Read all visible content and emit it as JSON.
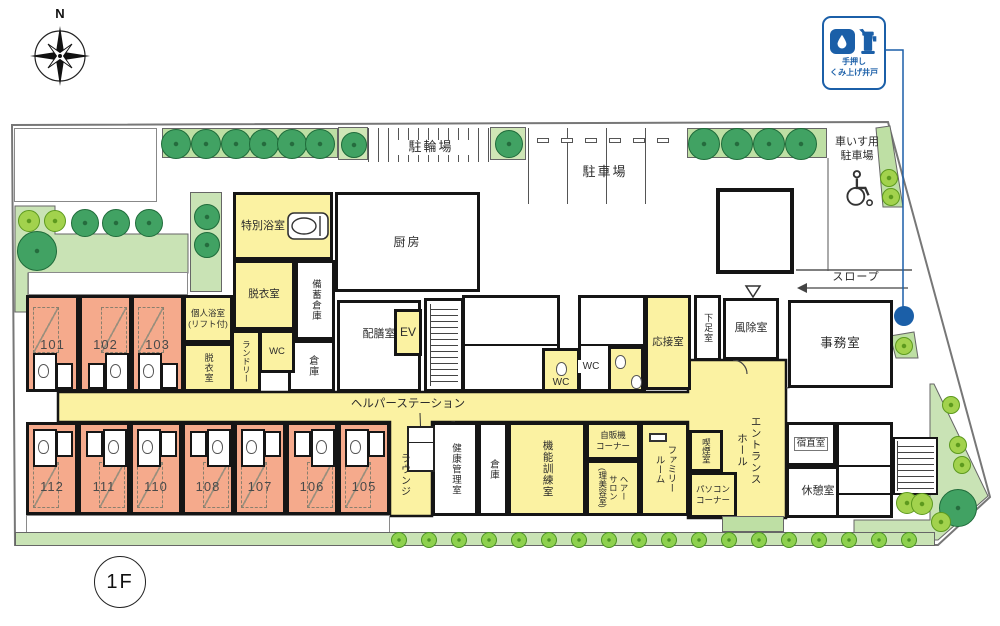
{
  "floor_label": "1F",
  "compass": {
    "north": "N"
  },
  "well_sign": {
    "line1": "手押し",
    "line2": "くみ上げ井戸"
  },
  "site": {
    "bicycle_parking": "駐輪場",
    "parking": "駐車場",
    "wheelchair_parking": "車いす用\n駐車場",
    "slope": "スロープ"
  },
  "rooms": {
    "tokubetsu_bath": "特別浴室",
    "kitchen": "厨房",
    "datsui_1": "脱衣室",
    "bichiku_souko": "備蓄倉庫",
    "kojin_bath": "個人浴室\n(リフト付)",
    "datsui_2": "脱衣室",
    "laundry": "ランドリー",
    "wc_a": "WC",
    "wc_b": "WC",
    "wc_c": "WC",
    "souko_a": "倉庫",
    "haizen": "配膳室",
    "elevator": "EV",
    "ousetsu": "応接室",
    "gesoku": "下足室",
    "fujo": "風除室",
    "jimu": "事務室",
    "helper_station": "ヘルパーステーション",
    "lounge": "ラウンジ",
    "kenko_kanri": "健康管理室",
    "souko_b": "倉庫",
    "kino_kunren": "機能訓練室",
    "jihanki": "自販機\nコーナー",
    "hair_salon": "ヘアー\nサロン\n(理美容室)",
    "family_room": "ファミリー\nルーム",
    "kitsuen": "喫煙室",
    "pc_corner": "パソコン\nコーナー",
    "entrance_hall": "エントランス\nホール",
    "shukuchoku": "宿直室",
    "kyukei": "休憩室"
  },
  "resident_rooms": {
    "top": [
      "101",
      "102",
      "103"
    ],
    "bottom": [
      "112",
      "111",
      "110",
      "108",
      "107",
      "106",
      "105"
    ]
  },
  "colors": {
    "room_pink": "#f5aa8c",
    "public_yellow": "#fbf2a2",
    "garden_green": "#c9e3b5",
    "hedge_green": "#bedfa4",
    "tree_dark": "#41a263",
    "tree_light": "#a2d24d",
    "accent_blue": "#1b5fa8",
    "wall": "#151515"
  }
}
